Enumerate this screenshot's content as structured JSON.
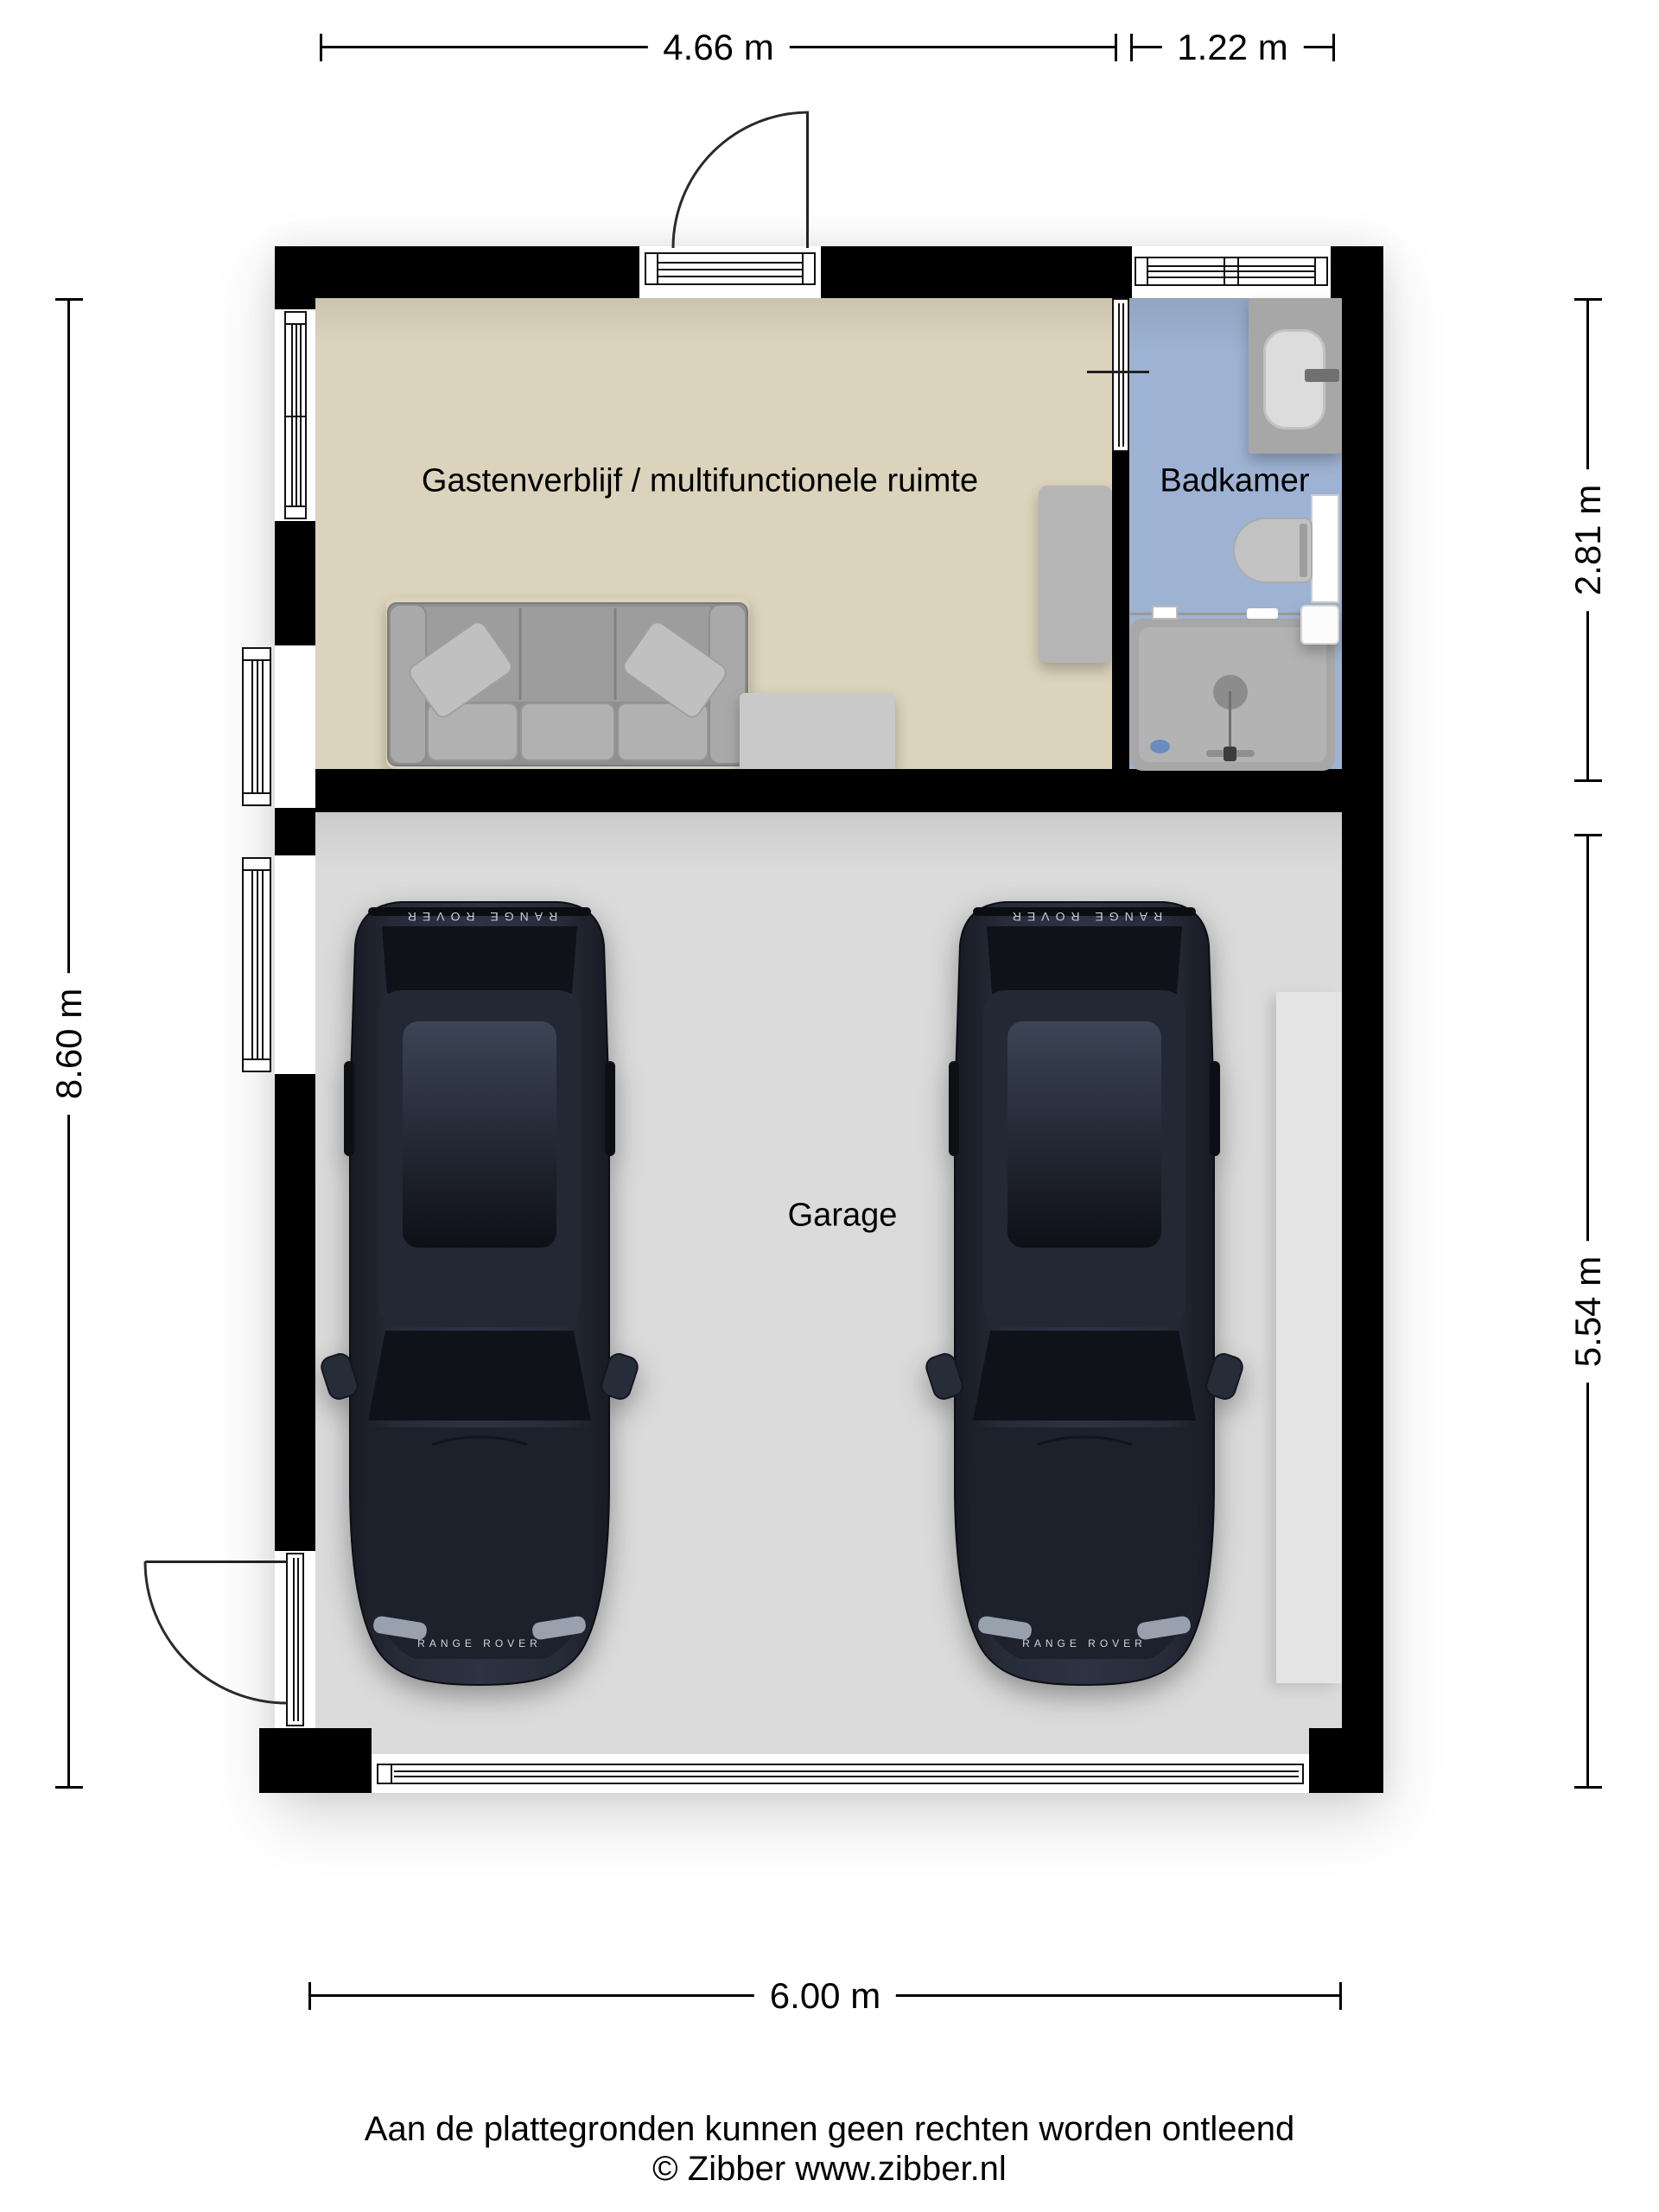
{
  "plan": {
    "rooms": {
      "guest": {
        "label": "Gastenverblijf / multifunctionele ruimte"
      },
      "bathroom": {
        "label": "Badkamer"
      },
      "garage": {
        "label": "Garage"
      }
    },
    "dimensions": {
      "top_guest": "4.66 m",
      "top_bathroom": "1.22 m",
      "left_total": "8.60 m",
      "right_bathroom": "2.81 m",
      "right_garage": "5.54 m",
      "bottom_garage": "6.00 m"
    },
    "cars": {
      "badge": "RANGE ROVER",
      "count": 2
    }
  },
  "footer": {
    "disclaimer": "Aan de plattegronden kunnen geen rechten worden ontleend",
    "copyright": "© Zibber www.zibber.nl"
  },
  "colors": {
    "wall": "#000000",
    "guest_floor": "#dbd3bc",
    "bathroom_floor": "#9eb3d3",
    "garage_floor": "#dbdbdb",
    "fixture_gray": "#ababab",
    "car_body": "#20242f"
  }
}
